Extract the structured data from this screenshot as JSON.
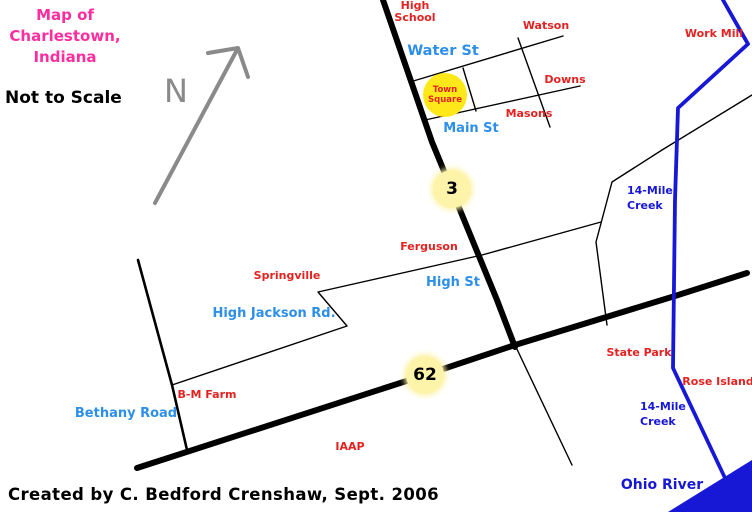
{
  "map": {
    "title": {
      "lines": [
        "Map of",
        "Charlestown,",
        "Indiana"
      ]
    },
    "scale_note": "Not to Scale",
    "compass": {
      "label": "N"
    },
    "credit": "Created by C. Bedford Crenshaw, Sept. 2006",
    "colors": {
      "title_pink": "#ff2e9e",
      "place_red": "#e32222",
      "street_blue": "#2e8fe8",
      "water_blue": "#1717d6",
      "road_black": "#000000",
      "arrow_gray": "#8a8a8a",
      "marker_fill": "#fdf3a9",
      "town_square_fill": "#ffe81a"
    },
    "highway_markers": [
      {
        "id": "highway-3-marker",
        "number": "3",
        "x": 452,
        "y": 189,
        "r": 19
      },
      {
        "id": "highway-62-marker",
        "number": "62",
        "x": 425,
        "y": 375,
        "r": 19
      }
    ],
    "town_square": {
      "id": "town-square-marker",
      "lines": [
        "Town",
        "Square"
      ],
      "x": 445,
      "y": 95,
      "r": 22
    },
    "labels": [
      {
        "id": "high-school-label",
        "lines": [
          "High",
          "School"
        ],
        "x": 415,
        "y": 0,
        "cls": "red",
        "align": "center"
      },
      {
        "id": "watson-label",
        "lines": [
          "Watson"
        ],
        "x": 546,
        "y": 20,
        "cls": "red",
        "align": "center"
      },
      {
        "id": "work-mill-label",
        "lines": [
          "Work Mill"
        ],
        "x": 714,
        "y": 28,
        "cls": "red",
        "align": "center"
      },
      {
        "id": "water-st-label",
        "lines": [
          "Water St"
        ],
        "x": 443,
        "y": 44,
        "cls": "street big",
        "align": "center"
      },
      {
        "id": "downs-label",
        "lines": [
          "Downs"
        ],
        "x": 565,
        "y": 74,
        "cls": "red",
        "align": "center"
      },
      {
        "id": "masons-label",
        "lines": [
          "Masons"
        ],
        "x": 529,
        "y": 108,
        "cls": "red",
        "align": "center"
      },
      {
        "id": "main-st-label",
        "lines": [
          "Main St"
        ],
        "x": 471,
        "y": 122,
        "cls": "street",
        "align": "center"
      },
      {
        "id": "creek-upper-label",
        "lines": [
          "14-Mile",
          "Creek"
        ],
        "x": 627,
        "y": 183,
        "cls": "water",
        "align": "left"
      },
      {
        "id": "ferguson-label",
        "lines": [
          "Ferguson"
        ],
        "x": 429,
        "y": 241,
        "cls": "red",
        "align": "center"
      },
      {
        "id": "springville-label",
        "lines": [
          "Springville"
        ],
        "x": 287,
        "y": 270,
        "cls": "red",
        "align": "center"
      },
      {
        "id": "high-st-label",
        "lines": [
          "High St"
        ],
        "x": 453,
        "y": 276,
        "cls": "street",
        "align": "center"
      },
      {
        "id": "high-jackson-label",
        "lines": [
          "High Jackson Rd."
        ],
        "x": 274,
        "y": 307,
        "cls": "street",
        "align": "center"
      },
      {
        "id": "state-park-label",
        "lines": [
          "State Park"
        ],
        "x": 639,
        "y": 347,
        "cls": "red",
        "align": "center"
      },
      {
        "id": "rose-island-label",
        "lines": [
          "Rose Island"
        ],
        "x": 718,
        "y": 376,
        "cls": "red",
        "align": "center"
      },
      {
        "id": "bm-farm-label",
        "lines": [
          "B-M Farm"
        ],
        "x": 207,
        "y": 389,
        "cls": "red",
        "align": "center"
      },
      {
        "id": "bethany-road-label",
        "lines": [
          "Bethany Road"
        ],
        "x": 126,
        "y": 407,
        "cls": "street",
        "align": "center"
      },
      {
        "id": "creek-lower-label",
        "lines": [
          "14-Mile",
          "Creek"
        ],
        "x": 640,
        "y": 399,
        "cls": "water",
        "align": "left"
      },
      {
        "id": "iaap-label",
        "lines": [
          "IAAP"
        ],
        "x": 350,
        "y": 441,
        "cls": "red",
        "align": "center"
      },
      {
        "id": "ohio-river-label",
        "lines": [
          "Ohio River"
        ],
        "x": 662,
        "y": 478,
        "cls": "water big",
        "align": "center"
      }
    ]
  }
}
